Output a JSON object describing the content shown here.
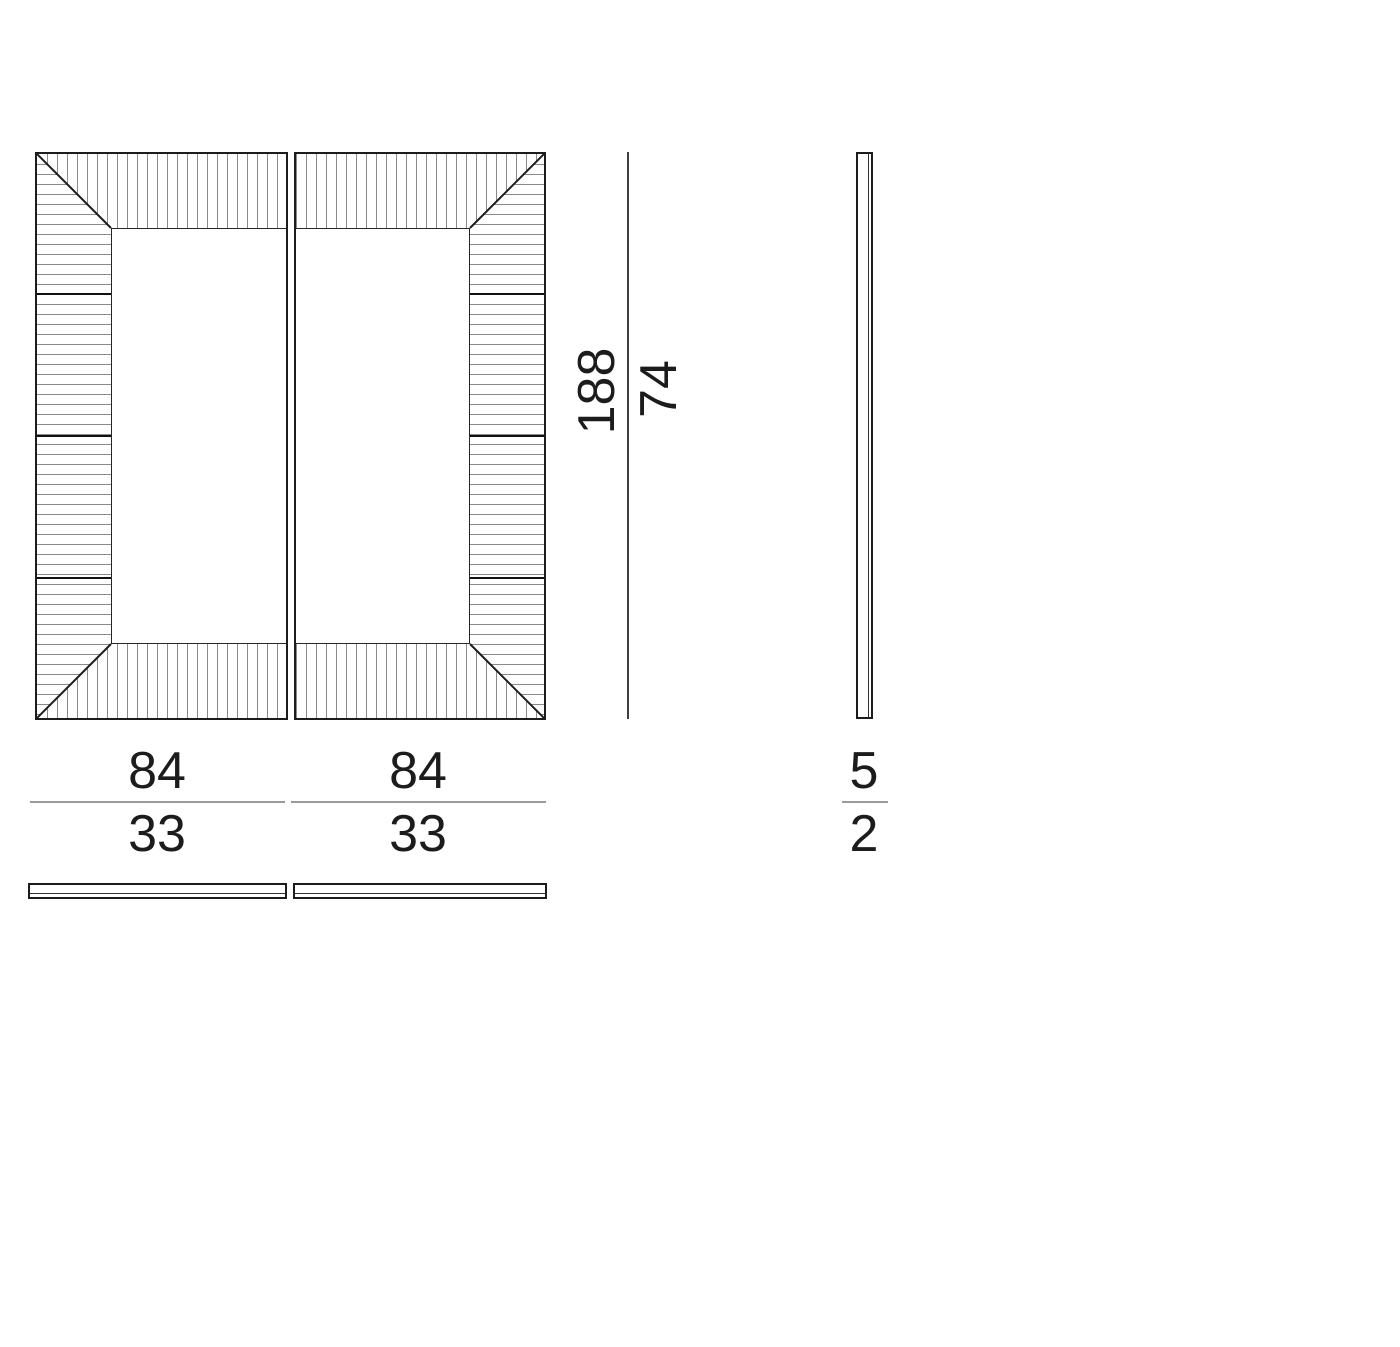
{
  "dimensions": {
    "height": {
      "primary": "188",
      "secondary": "74"
    },
    "width_left": {
      "primary": "84",
      "secondary": "33"
    },
    "width_right": {
      "primary": "84",
      "secondary": "33"
    },
    "depth": {
      "primary": "5",
      "secondary": "2"
    }
  },
  "colors": {
    "outline": "#1c1c1c",
    "hatch": "#8a8a8a",
    "segment_joint": "#111111",
    "dimension_line_horizontal": "#9b9b9b",
    "dimension_line_vertical": "#3f3f3f",
    "text": "#1c1c1c",
    "background": "#ffffff"
  }
}
